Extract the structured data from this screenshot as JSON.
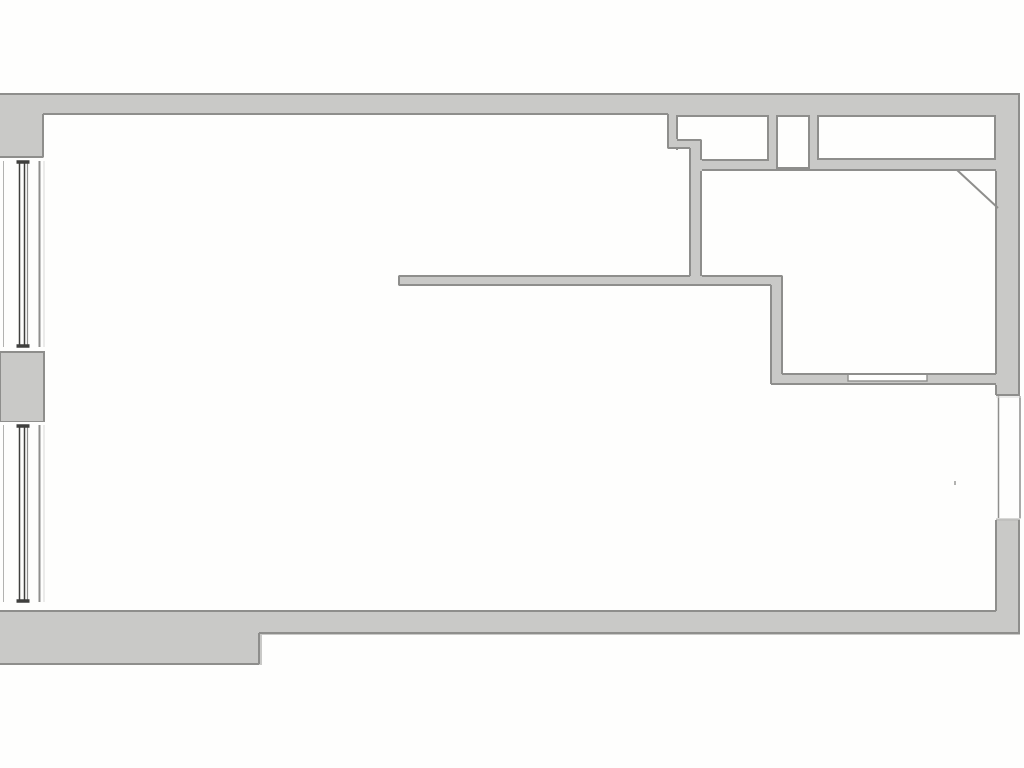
{
  "canvas": {
    "width": 1024,
    "height": 768,
    "background": "#fefefd"
  },
  "palette": {
    "wall_fill": "#c9c9c7",
    "wall_edge": "#8e8e8c",
    "edge_light": "#c0c0be",
    "glass_dark": "#3f3f3d",
    "glass_mid": "#8f8f8d",
    "glass_light": "#b2b2b0",
    "glass_faint": "#d8d8d6",
    "inset_fill": "#fefefd"
  },
  "floorplan": {
    "wall_rects": [
      {
        "name": "top-exterior-wall",
        "x": 0,
        "y": 93,
        "w": 1020,
        "h": 22
      },
      {
        "name": "top-left-corner-wall",
        "x": 0,
        "y": 93,
        "w": 44,
        "h": 65
      },
      {
        "name": "bottom-left-exterior-wall",
        "x": 0,
        "y": 611,
        "w": 262,
        "h": 54
      },
      {
        "name": "bottom-exterior-wall",
        "x": 258,
        "y": 611,
        "w": 762,
        "h": 24
      },
      {
        "name": "right-exterior-wall-upper",
        "x": 995,
        "y": 93,
        "w": 25,
        "h": 302
      },
      {
        "name": "right-exterior-wall-lower",
        "x": 995,
        "y": 520,
        "w": 25,
        "h": 115
      },
      {
        "name": "closet-partition-stub",
        "x": 667,
        "y": 113,
        "w": 10,
        "h": 36
      },
      {
        "name": "closet-partition-jog",
        "x": 667,
        "y": 139,
        "w": 35,
        "h": 10
      },
      {
        "name": "hall-partition-wall",
        "x": 691,
        "y": 139,
        "w": 11,
        "h": 147
      },
      {
        "name": "closet-bottom-wall",
        "x": 691,
        "y": 158,
        "w": 306,
        "h": 13
      },
      {
        "name": "closet-divider-left",
        "x": 768,
        "y": 113,
        "w": 9,
        "h": 58
      },
      {
        "name": "closet-divider-right",
        "x": 809,
        "y": 113,
        "w": 9,
        "h": 58
      },
      {
        "name": "mid-partition-wall",
        "x": 398,
        "y": 275,
        "w": 385,
        "h": 11
      },
      {
        "name": "right-room-partition-wall",
        "x": 772,
        "y": 275,
        "w": 11,
        "h": 110
      },
      {
        "name": "lower-partition-wall",
        "x": 772,
        "y": 374,
        "w": 225,
        "h": 11
      }
    ],
    "insets": [
      {
        "name": "closet-1-interior",
        "x": 677,
        "y": 116,
        "w": 91,
        "h": 44,
        "sw": 2
      },
      {
        "name": "wall-niche-interior",
        "x": 777,
        "y": 116,
        "w": 32,
        "h": 52,
        "sw": 2
      },
      {
        "name": "closet-2-interior",
        "x": 818,
        "y": 116,
        "w": 177,
        "h": 43,
        "sw": 2
      },
      {
        "name": "pass-through-opening",
        "x": 848,
        "y": 374,
        "w": 79,
        "h": 7,
        "sw": 1.4
      }
    ],
    "edges": [
      {
        "x1": 0,
        "y1": 94,
        "x2": 1020,
        "y2": 94
      },
      {
        "x1": 43,
        "y1": 114,
        "x2": 668,
        "y2": 114
      },
      {
        "x1": 0,
        "y1": 157,
        "x2": 43,
        "y2": 157
      },
      {
        "x1": 43,
        "y1": 114,
        "x2": 43,
        "y2": 157
      },
      {
        "x1": 702,
        "y1": 170,
        "x2": 996,
        "y2": 170
      },
      {
        "x1": 701,
        "y1": 171,
        "x2": 701,
        "y2": 276
      },
      {
        "x1": 996,
        "y1": 171,
        "x2": 996,
        "y2": 374
      },
      {
        "x1": 399,
        "y1": 276,
        "x2": 690,
        "y2": 276
      },
      {
        "x1": 702,
        "y1": 276,
        "x2": 782,
        "y2": 276
      },
      {
        "x1": 399,
        "y1": 276,
        "x2": 399,
        "y2": 285
      },
      {
        "x1": 399,
        "y1": 285,
        "x2": 771,
        "y2": 285
      },
      {
        "x1": 771,
        "y1": 285,
        "x2": 771,
        "y2": 384
      },
      {
        "x1": 782,
        "y1": 276,
        "x2": 782,
        "y2": 374
      },
      {
        "x1": 782,
        "y1": 374,
        "x2": 996,
        "y2": 374
      },
      {
        "x1": 771,
        "y1": 384,
        "x2": 996,
        "y2": 384
      },
      {
        "x1": 996,
        "y1": 385,
        "x2": 996,
        "y2": 395
      },
      {
        "x1": 996,
        "y1": 395,
        "x2": 1020,
        "y2": 395
      },
      {
        "x1": 996,
        "y1": 520,
        "x2": 1020,
        "y2": 520,
        "c": "edge_light"
      },
      {
        "x1": 996,
        "y1": 520,
        "x2": 996,
        "y2": 611
      },
      {
        "x1": 1019,
        "y1": 94,
        "x2": 1019,
        "y2": 395
      },
      {
        "x1": 1019,
        "y1": 520,
        "x2": 1019,
        "y2": 633
      },
      {
        "x1": 0,
        "y1": 611,
        "x2": 996,
        "y2": 611
      },
      {
        "x1": 259,
        "y1": 633,
        "x2": 1020,
        "y2": 633
      },
      {
        "x1": 259,
        "y1": 633,
        "x2": 259,
        "y2": 664
      },
      {
        "x1": 0,
        "y1": 664,
        "x2": 259,
        "y2": 664
      }
    ],
    "patches": [
      {
        "name": "room-corner-patch",
        "fill": "inset",
        "x": 666,
        "y": 150,
        "w": 26,
        "h": 12
      },
      {
        "name": "closet-partition-jog-top",
        "fill": "wall",
        "x": 667,
        "y": 139,
        "w": 35,
        "h": 10
      },
      {
        "name": "hall-partition-top",
        "fill": "wall",
        "x": 691,
        "y": 139,
        "w": 11,
        "h": 31
      }
    ],
    "step_edges": [
      {
        "x1": 668,
        "y1": 114,
        "x2": 668,
        "y2": 148
      },
      {
        "x1": 668,
        "y1": 148,
        "x2": 690,
        "y2": 148
      },
      {
        "x1": 690,
        "y1": 148,
        "x2": 690,
        "y2": 276
      },
      {
        "x1": 677,
        "y1": 140,
        "x2": 701,
        "y2": 140
      },
      {
        "x1": 701,
        "y1": 140,
        "x2": 701,
        "y2": 160
      }
    ],
    "pier": {
      "x": 0,
      "y": 352,
      "w": 44,
      "h": 70
    },
    "diagonal": {
      "x1": 957,
      "y1": 170,
      "x2": 998,
      "y2": 208
    },
    "left_windows": {
      "strip": {
        "x": 0,
        "w": 45
      },
      "segments": [
        {
          "white_top": 158,
          "white_bottom": 351,
          "glass_top": 161,
          "glass_bottom": 347
        },
        {
          "white_top": 422,
          "white_bottom": 608,
          "glass_top": 425,
          "glass_bottom": 602
        }
      ],
      "lines": [
        {
          "x": 3.5,
          "w": 1,
          "c": "glass_light"
        },
        {
          "x": 19.5,
          "w": 1.5,
          "c": "glass_dark"
        },
        {
          "x": 24.5,
          "w": 1.5,
          "c": "glass_dark"
        },
        {
          "x": 27.5,
          "w": 1.2,
          "c": "glass_mid"
        },
        {
          "x": 39.5,
          "w": 2,
          "c": "glass_mid"
        },
        {
          "x": 44,
          "w": 1,
          "c": "glass_faint"
        }
      ],
      "cap": {
        "x1": 16.5,
        "x2": 29.5,
        "w": 3.5,
        "c": "glass_dark"
      }
    },
    "right_window": {
      "rect": {
        "x": 996,
        "y": 396,
        "w": 25,
        "h": 123
      },
      "vlines": [
        {
          "x": 998.5,
          "w": 1.5,
          "c": "glass_mid"
        },
        {
          "x": 1020,
          "w": 1.5,
          "c": "glass_mid"
        }
      ],
      "hlines": [
        {
          "y": 397,
          "c": "glass_faint"
        },
        {
          "y": 518.5,
          "c": "glass_faint"
        }
      ]
    },
    "dot": {
      "x": 954,
      "y": 481,
      "w": 2,
      "h": 4
    }
  }
}
